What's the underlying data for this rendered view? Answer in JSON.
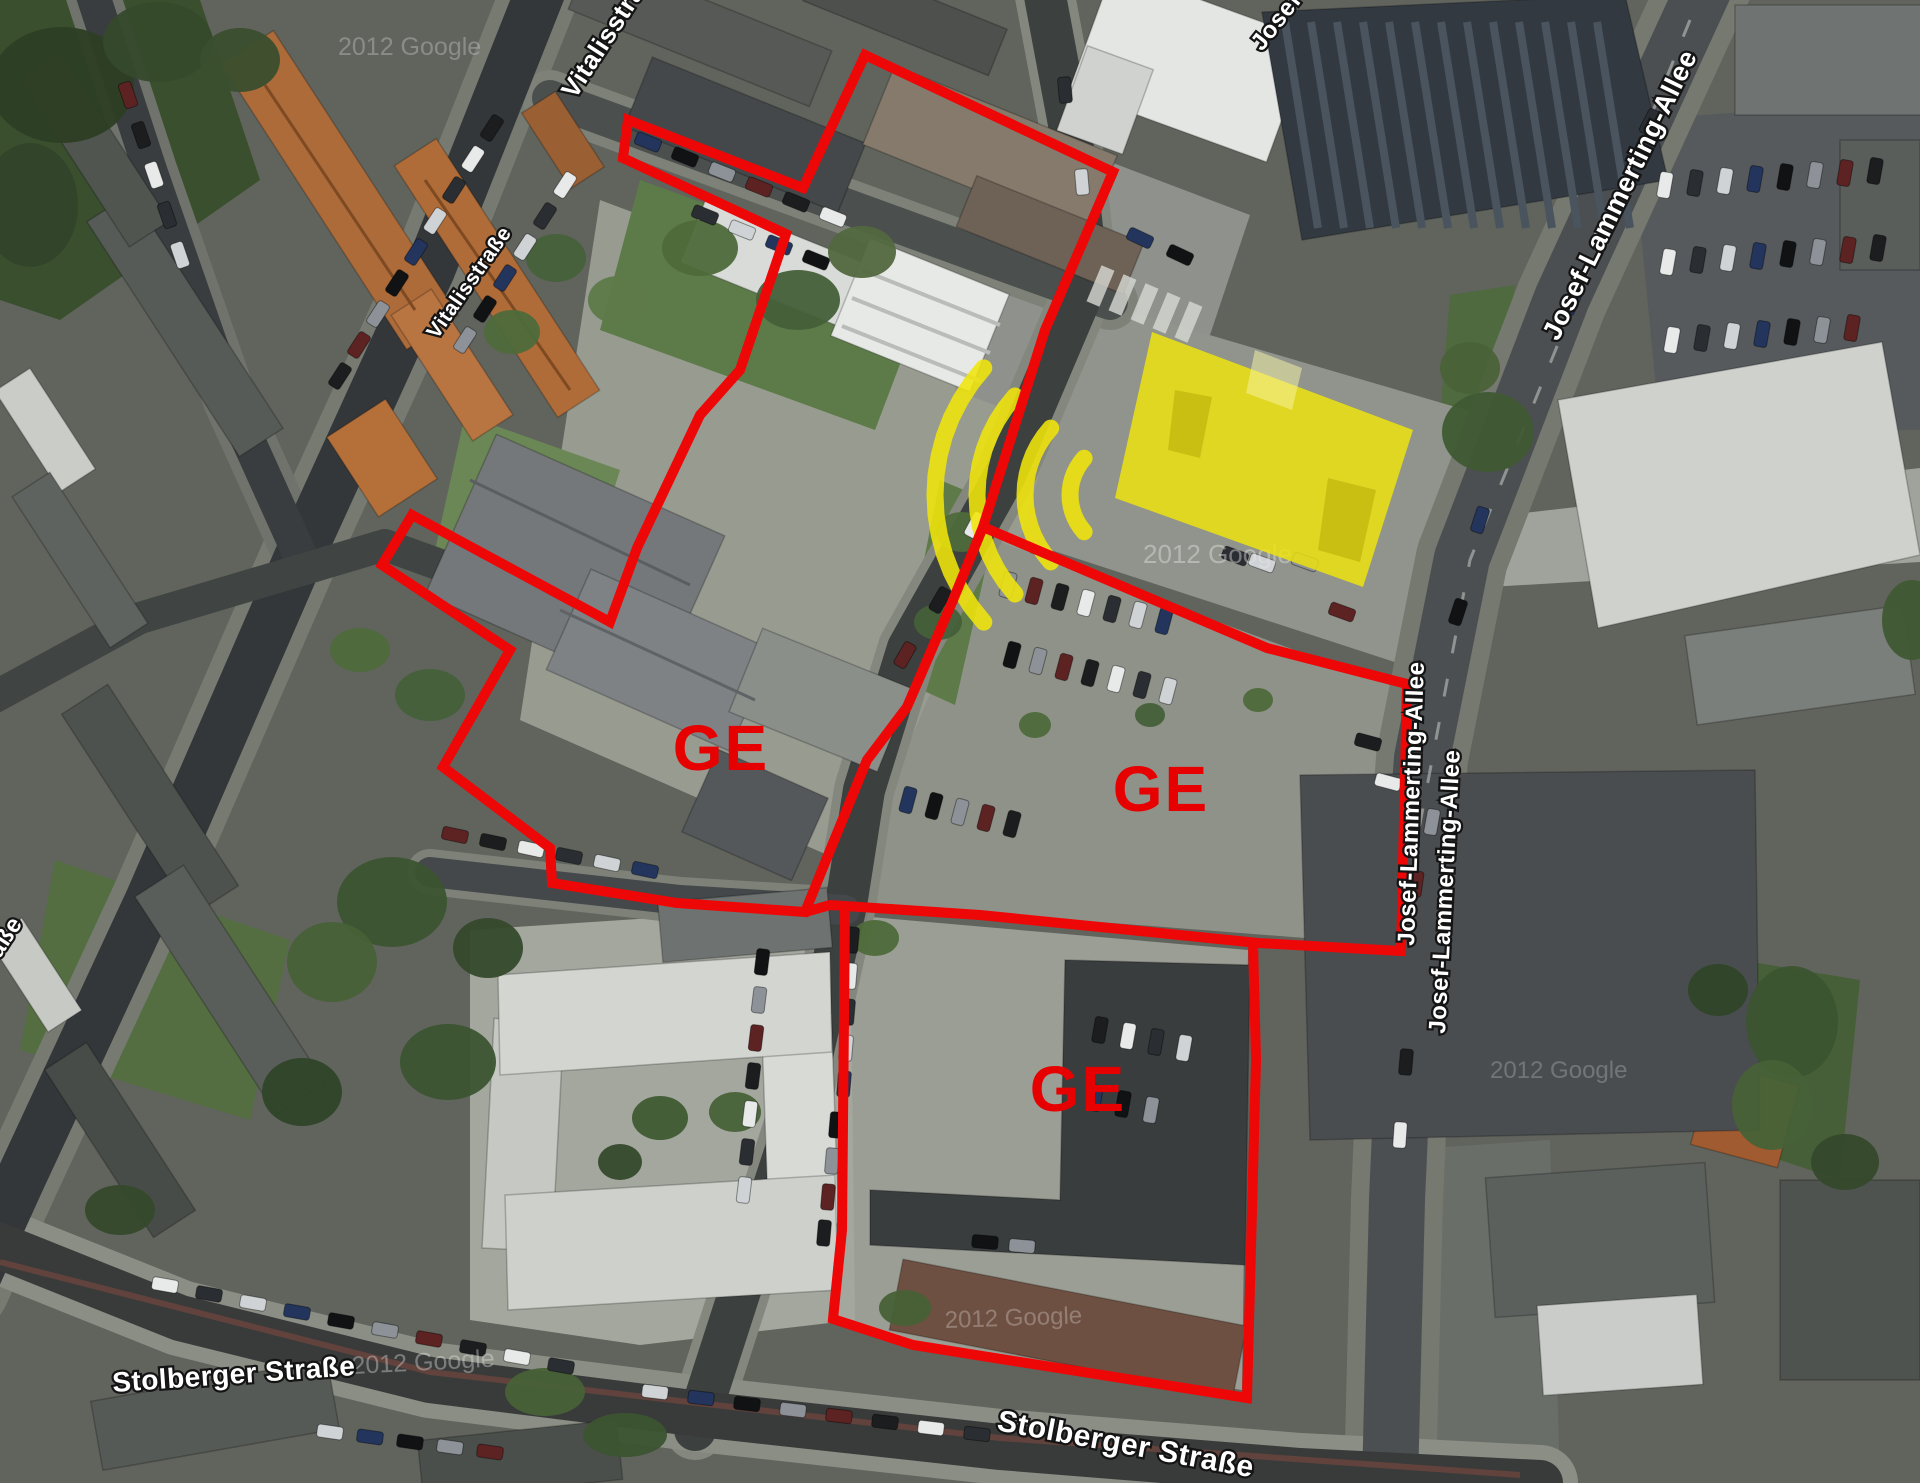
{
  "map": {
    "type": "satellite-annotation",
    "colors": {
      "zone_red": "#ee0707",
      "ge_text_red": "#e60000",
      "highlight_yellow": "#f0e50a",
      "label_fill": "#ffffff",
      "label_outline": "#141414",
      "watermark_gray": "#e8e8e8"
    },
    "street_labels": [
      {
        "name": "vitalisstrasse-top",
        "text": "Vitalisstraße",
        "x": 575,
        "y": 100,
        "rotate": -57,
        "size": 26
      },
      {
        "name": "vitalisstrasse-mid",
        "text": "Vitalisstraße",
        "x": 437,
        "y": 340,
        "rotate": -55,
        "size": 21
      },
      {
        "name": "vitalisstrasse-left",
        "text": "Vitalisstraße",
        "x": -58,
        "y": 1048,
        "rotate": -57,
        "size": 24
      },
      {
        "name": "stolberger-strasse-west",
        "text": "Stolberger Straße",
        "x": 113,
        "y": 1392,
        "rotate": -4,
        "size": 28
      },
      {
        "name": "stolberger-strasse-south",
        "text": "Stolberger Straße",
        "x": 996,
        "y": 1430,
        "rotate": 10.5,
        "size": 30
      },
      {
        "name": "josef-lammerting-allee-top",
        "text": "Josef-Lammerting-Allee",
        "x": 1262,
        "y": 52,
        "rotate": -52,
        "size": 24
      },
      {
        "name": "josef-lammerting-allee-ne",
        "text": "Josef-Lammerting-Allee",
        "x": 1558,
        "y": 342,
        "rotate": -64,
        "size": 27
      },
      {
        "name": "josef-lammerting-allee-mid-a",
        "text": "Josef-Lammerting-Allee",
        "x": 1414,
        "y": 946,
        "rotate": -88,
        "size": 24
      },
      {
        "name": "josef-lammerting-allee-mid-b",
        "text": "Josef-Lammerting-Allee",
        "x": 1445,
        "y": 1034,
        "rotate": -87,
        "size": 24
      }
    ],
    "watermarks": [
      {
        "text": "2012 Google",
        "x": 1143,
        "y": 563,
        "rotate": 0,
        "size": 26,
        "opacity": 0.42
      },
      {
        "text": "2012 Google",
        "x": 352,
        "y": 1374,
        "rotate": -3,
        "size": 25,
        "opacity": 0.38
      },
      {
        "text": "2012 Google",
        "x": 945,
        "y": 1328,
        "rotate": -2,
        "size": 24,
        "opacity": 0.3
      },
      {
        "text": "2012 Google",
        "x": 338,
        "y": 55,
        "rotate": 0,
        "size": 25,
        "opacity": 0.3
      },
      {
        "text": "2012 Google",
        "x": 1490,
        "y": 1078,
        "rotate": 0,
        "size": 24,
        "opacity": 0.25
      }
    ],
    "zones": [
      {
        "id": "ge-west",
        "label": "GE",
        "label_x": 721,
        "label_y": 748,
        "label_size": 64,
        "closed": true,
        "outline": [
          [
            865,
            55
          ],
          [
            1113,
            172
          ],
          [
            1045,
            330
          ],
          [
            983,
            527
          ],
          [
            953,
            600
          ],
          [
            907,
            707
          ],
          [
            867,
            760
          ],
          [
            833,
            843
          ],
          [
            805,
            912
          ],
          [
            677,
            903
          ],
          [
            552,
            883
          ],
          [
            550,
            848
          ],
          [
            443,
            767
          ],
          [
            510,
            650
          ],
          [
            382,
            565
          ],
          [
            412,
            515
          ],
          [
            610,
            622
          ],
          [
            637,
            548
          ],
          [
            700,
            415
          ],
          [
            740,
            370
          ],
          [
            786,
            234
          ],
          [
            623,
            158
          ],
          [
            628,
            120
          ],
          [
            803,
            188
          ]
        ]
      },
      {
        "id": "ge-center",
        "label": "GE",
        "label_x": 1161,
        "label_y": 789,
        "label_size": 64,
        "closed": false,
        "outline": [
          [
            983,
            527
          ],
          [
            1267,
            648
          ],
          [
            1407,
            684
          ],
          [
            1401,
            951
          ],
          [
            1258,
            943
          ],
          [
            1130,
            930
          ],
          [
            980,
            915
          ],
          [
            830,
            905
          ],
          [
            805,
            912
          ]
        ]
      },
      {
        "id": "ge-south",
        "label": "GE",
        "label_x": 1078,
        "label_y": 1089,
        "label_size": 64,
        "closed": false,
        "outline": [
          [
            845,
            907
          ],
          [
            842,
            1230
          ],
          [
            833,
            1319
          ],
          [
            913,
            1345
          ],
          [
            1247,
            1398
          ],
          [
            1256,
            1060
          ],
          [
            1253,
            943
          ]
        ]
      }
    ],
    "highlight": {
      "building_polygon": [
        [
          1152,
          332
        ],
        [
          1413,
          430
        ],
        [
          1363,
          587
        ],
        [
          1115,
          498
        ]
      ],
      "building_opacity": 0.82,
      "waves": {
        "cx": 1125,
        "cy": 495,
        "radii": [
          55,
          100,
          148,
          190
        ],
        "start_angle": 138,
        "end_angle": 222,
        "stroke_width": 17,
        "opacity": 0.88
      }
    }
  }
}
